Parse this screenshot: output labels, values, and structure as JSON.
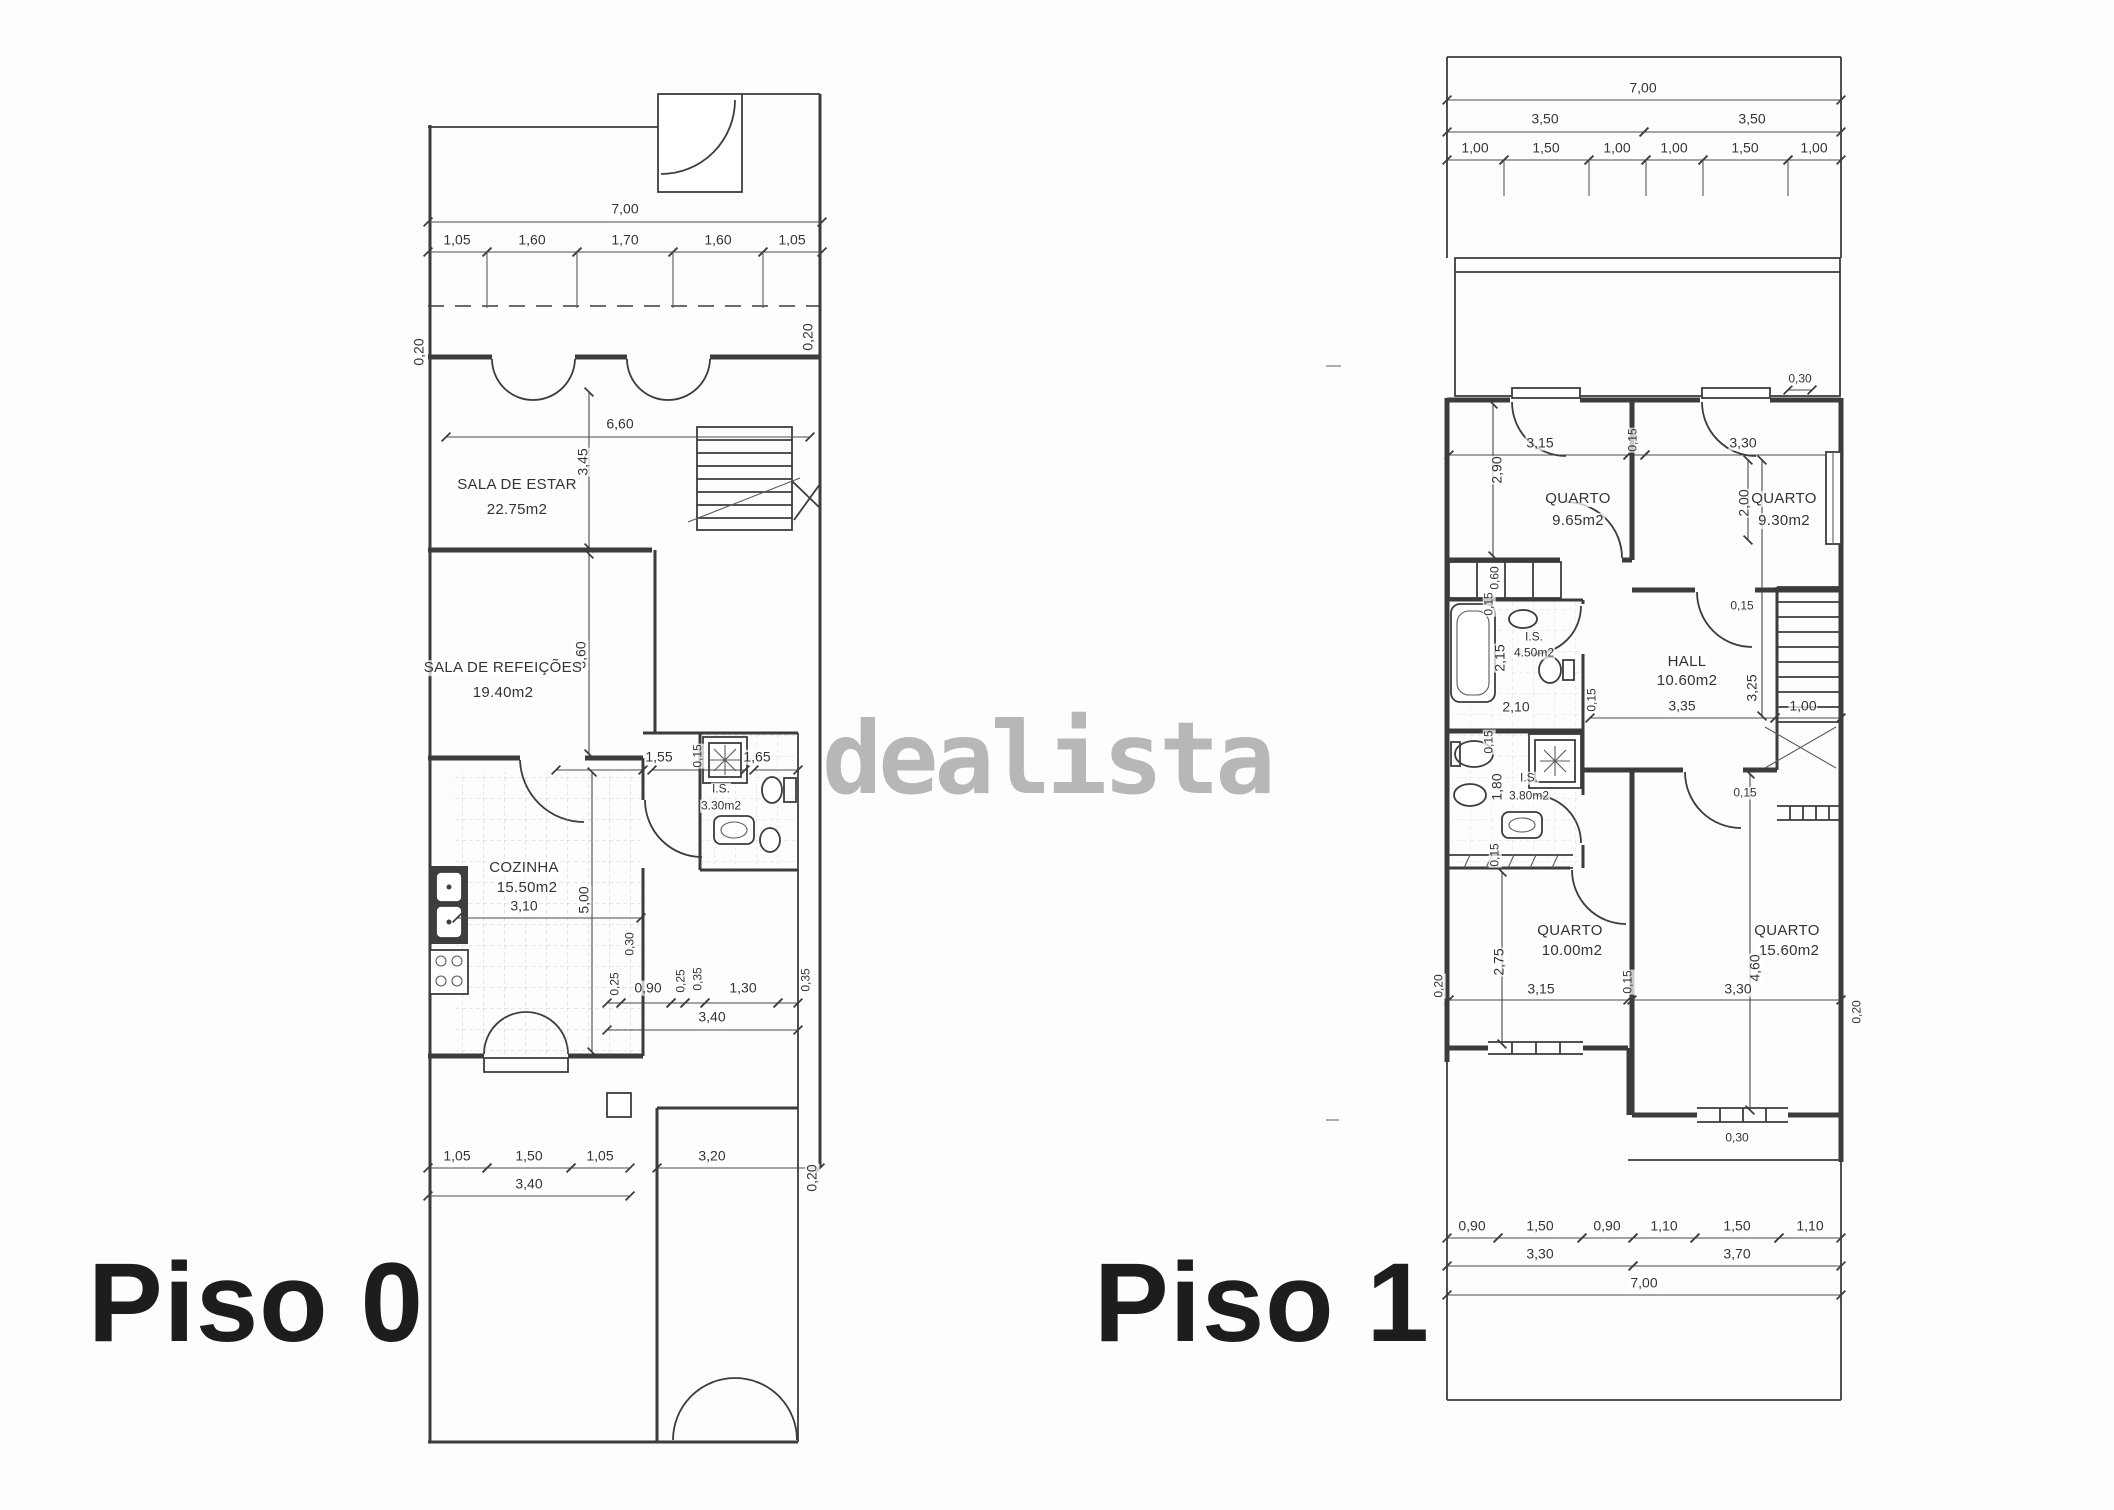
{
  "watermark": "dealista",
  "p0": {
    "title": "Piso 0",
    "rooms": {
      "estar_name": "SALA DE ESTAR",
      "estar_area": "22.75m2",
      "refeicoes_name": "SALA DE REFEIÇÕES",
      "refeicoes_area": "19.40m2",
      "cozinha_name": "COZINHA",
      "cozinha_area": "15.50m2",
      "is_name": "I.S.",
      "is_area": "3.30m2"
    },
    "d": {
      "total_w": "7,00",
      "top": [
        "1,05",
        "1,60",
        "1,70",
        "1,60",
        "1,05"
      ],
      "wall_l": "0,20",
      "wall_r": "0,20",
      "estar_w": "6,60",
      "estar_h": "3,45",
      "refeicoes_h": "3,60",
      "coz_w": "3,10",
      "coz_h": "5,00",
      "hall_w": "0,30",
      "bath": [
        "1,55",
        "0,15",
        "1,65"
      ],
      "mid": [
        "0,25",
        "0,90",
        "0,25",
        "0,35",
        "1,30",
        "0,35"
      ],
      "mid_total": "3,40",
      "bot": [
        "1,05",
        "1,50",
        "1,05"
      ],
      "bot_r": "3,20",
      "bot_total": "3,40",
      "wall_rb": "0,20"
    }
  },
  "p1": {
    "title": "Piso 1",
    "rooms": {
      "q1_name": "QUARTO",
      "q1_area": "9.65m2",
      "q2_name": "QUARTO",
      "q2_area": "9.30m2",
      "hall_name": "HALL",
      "hall_area": "10.60m2",
      "is1_name": "I.S.",
      "is1_area": "4.50m2",
      "is2_name": "I.S.",
      "is2_area": "3.80m2",
      "q3_name": "QUARTO",
      "q3_area": "10.00m2",
      "q4_name": "QUARTO",
      "q4_area": "15.60m2"
    },
    "d": {
      "total_w": "7,00",
      "half_l": "3,50",
      "half_r": "3,50",
      "top": [
        "1,00",
        "1,50",
        "1,00",
        "1,00",
        "1,50",
        "1,00"
      ],
      "balc": "0,30",
      "q1_w": "3,15",
      "q12_wall": "0,15",
      "q2_w": "3,30",
      "q1_h": "2,90",
      "q2_h": "2,00",
      "ward": "0,60",
      "is1_t": "0,15",
      "is1_h": "2,15",
      "is1_w": "2,10",
      "is1_r": "0,15",
      "hall_t": "0,15",
      "hall_w": "3,35",
      "hall_h": "3,25",
      "stair_w": "1,00",
      "hall_b": "0,15",
      "is2_t": "0,15",
      "is2_h": "1,80",
      "is2_b": "0,15",
      "q3_h": "2,75",
      "q3_w": "3,15",
      "q34_wall": "0,15",
      "q4_w": "3,30",
      "q4_h": "4,60",
      "wall_l": "0,20",
      "wall_r": "0,20",
      "win_b": "0,30",
      "bot": [
        "0,90",
        "1,50",
        "0,90",
        "1,10",
        "1,50",
        "1,10"
      ],
      "bot_l": "3,30",
      "bot_r": "3,70",
      "bot_total": "7,00"
    }
  }
}
